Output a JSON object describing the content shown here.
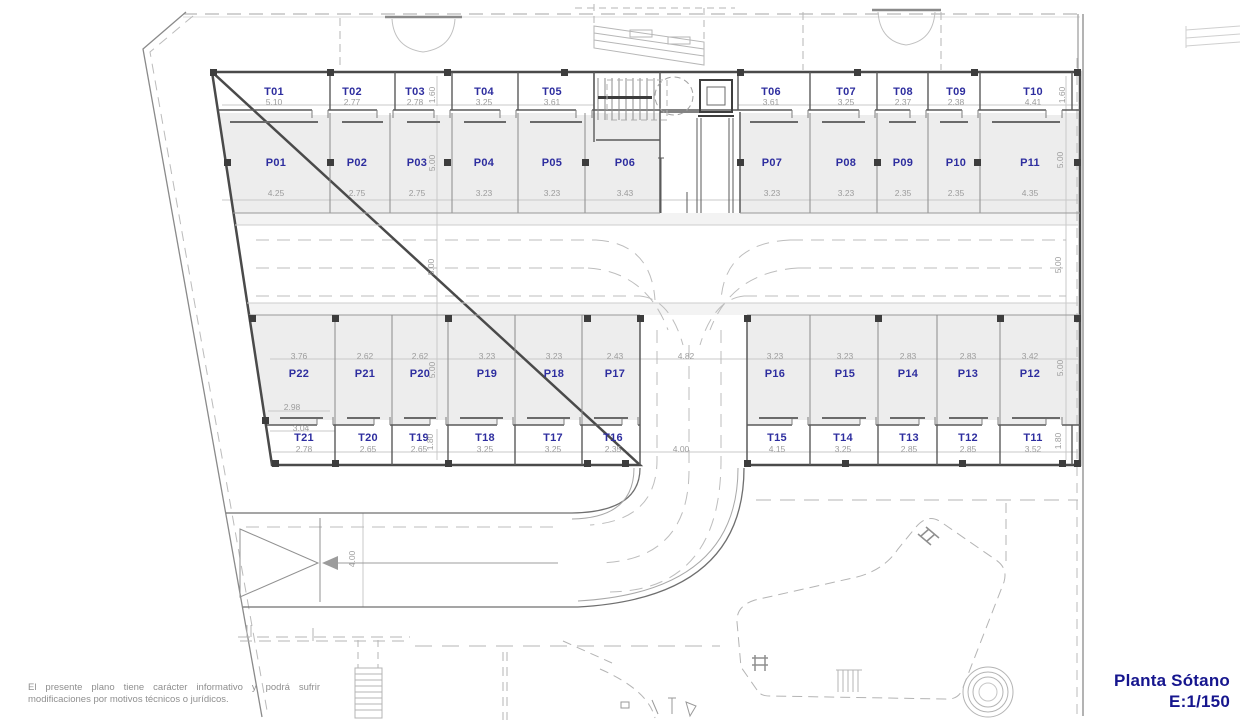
{
  "title": {
    "line1": "Planta Sótano",
    "line2": "E:1/150"
  },
  "disclaimer": {
    "line1": "El presente plano tiene carácter informativo y podrá sufrir",
    "line2": "modificaciones por motivos técnicos o jurídicos."
  },
  "colors": {
    "label_blue": "#2e2e9f",
    "title_blue": "#16168e",
    "dim_gray": "#9c9c9c",
    "stall_fill": "#ededed",
    "wall_dark": "#4a4a4a",
    "light_line": "#b6b6b6"
  },
  "plan": {
    "rows": {
      "storage_top": {
        "label_y": 92,
        "dim_y": 102,
        "items": [
          {
            "label": "T01",
            "dim": "5.10",
            "x": 274
          },
          {
            "label": "T02",
            "dim": "2.77",
            "x": 352
          },
          {
            "label": "T03",
            "dim": "2.78",
            "x": 415
          },
          {
            "label": "T04",
            "dim": "3.25",
            "x": 484
          },
          {
            "label": "T05",
            "dim": "3.61",
            "x": 552
          },
          {
            "label": "T06",
            "dim": "3.61",
            "x": 771
          },
          {
            "label": "T07",
            "dim": "3.25",
            "x": 846
          },
          {
            "label": "T08",
            "dim": "2.37",
            "x": 903
          },
          {
            "label": "T09",
            "dim": "2.38",
            "x": 956
          },
          {
            "label": "T10",
            "dim": "4.41",
            "x": 1033
          }
        ]
      },
      "parking_top": {
        "label_y": 163,
        "dim_y": 193,
        "items": [
          {
            "label": "P01",
            "dim": "4.25",
            "x": 276
          },
          {
            "label": "P02",
            "dim": "2.75",
            "x": 357
          },
          {
            "label": "P03",
            "dim": "2.75",
            "x": 417
          },
          {
            "label": "P04",
            "dim": "3.23",
            "x": 484
          },
          {
            "label": "P05",
            "dim": "3.23",
            "x": 552
          },
          {
            "label": "P06",
            "dim": "3.43",
            "x": 625
          },
          {
            "label": "P07",
            "dim": "3.23",
            "x": 772
          },
          {
            "label": "P08",
            "dim": "3.23",
            "x": 846
          },
          {
            "label": "P09",
            "dim": "2.35",
            "x": 903
          },
          {
            "label": "P10",
            "dim": "2.35",
            "x": 956
          },
          {
            "label": "P11",
            "dim": "4.35",
            "x": 1030
          }
        ]
      },
      "parking_bottom": {
        "label_y": 374,
        "dim_y": 356,
        "items": [
          {
            "label": "P22",
            "dim": "3.76",
            "x": 299
          },
          {
            "label": "P21",
            "dim": "2.62",
            "x": 365
          },
          {
            "label": "P20",
            "dim": "2.62",
            "x": 420
          },
          {
            "label": "P19",
            "dim": "3.23",
            "x": 487
          },
          {
            "label": "P18",
            "dim": "3.23",
            "x": 554
          },
          {
            "label": "P17",
            "dim": "2.43",
            "x": 615
          },
          {
            "label": "P16",
            "dim": "3.23",
            "x": 775
          },
          {
            "label": "P15",
            "dim": "3.23",
            "x": 845
          },
          {
            "label": "P14",
            "dim": "2.83",
            "x": 908
          },
          {
            "label": "P13",
            "dim": "2.83",
            "x": 968
          },
          {
            "label": "P12",
            "dim": "3.42",
            "x": 1030
          }
        ]
      },
      "storage_bottom": {
        "label_y": 438,
        "dim_y": 449,
        "items": [
          {
            "label": "T21",
            "dim": "2.78",
            "x": 304
          },
          {
            "label": "T20",
            "dim": "2.65",
            "x": 368
          },
          {
            "label": "T19",
            "dim": "2.65",
            "x": 419
          },
          {
            "label": "T18",
            "dim": "3.25",
            "x": 485
          },
          {
            "label": "T17",
            "dim": "3.25",
            "x": 553
          },
          {
            "label": "T16",
            "dim": "2.35",
            "x": 613
          },
          {
            "label": "T15",
            "dim": "4.15",
            "x": 777
          },
          {
            "label": "T14",
            "dim": "3.25",
            "x": 843
          },
          {
            "label": "T13",
            "dim": "2.85",
            "x": 909
          },
          {
            "label": "T12",
            "dim": "2.85",
            "x": 968
          },
          {
            "label": "T11",
            "dim": "3.52",
            "x": 1033
          }
        ]
      }
    },
    "extra_dims": [
      {
        "text": "1.60",
        "x": 432,
        "y": 95,
        "vertical": true
      },
      {
        "text": "5.00",
        "x": 432,
        "y": 163,
        "vertical": true
      },
      {
        "text": "5.00",
        "x": 431,
        "y": 267,
        "vertical": true
      },
      {
        "text": "5.00",
        "x": 432,
        "y": 370,
        "vertical": true
      },
      {
        "text": "1.80",
        "x": 430,
        "y": 442,
        "vertical": true
      },
      {
        "text": "1.60",
        "x": 1062,
        "y": 95,
        "vertical": true
      },
      {
        "text": "5.00",
        "x": 1060,
        "y": 160,
        "vertical": true
      },
      {
        "text": "5.00",
        "x": 1058,
        "y": 265,
        "vertical": true
      },
      {
        "text": "5.00",
        "x": 1060,
        "y": 368,
        "vertical": true
      },
      {
        "text": "1.80",
        "x": 1058,
        "y": 441,
        "vertical": true
      },
      {
        "text": "4.82",
        "x": 686,
        "y": 356,
        "vertical": false
      },
      {
        "text": "4.00",
        "x": 681,
        "y": 449,
        "vertical": false
      },
      {
        "text": "4.00",
        "x": 352,
        "y": 559,
        "vertical": true
      },
      {
        "text": "2.98",
        "x": 292,
        "y": 407,
        "vertical": false
      },
      {
        "text": "3.04",
        "x": 301,
        "y": 428,
        "vertical": false
      }
    ]
  }
}
